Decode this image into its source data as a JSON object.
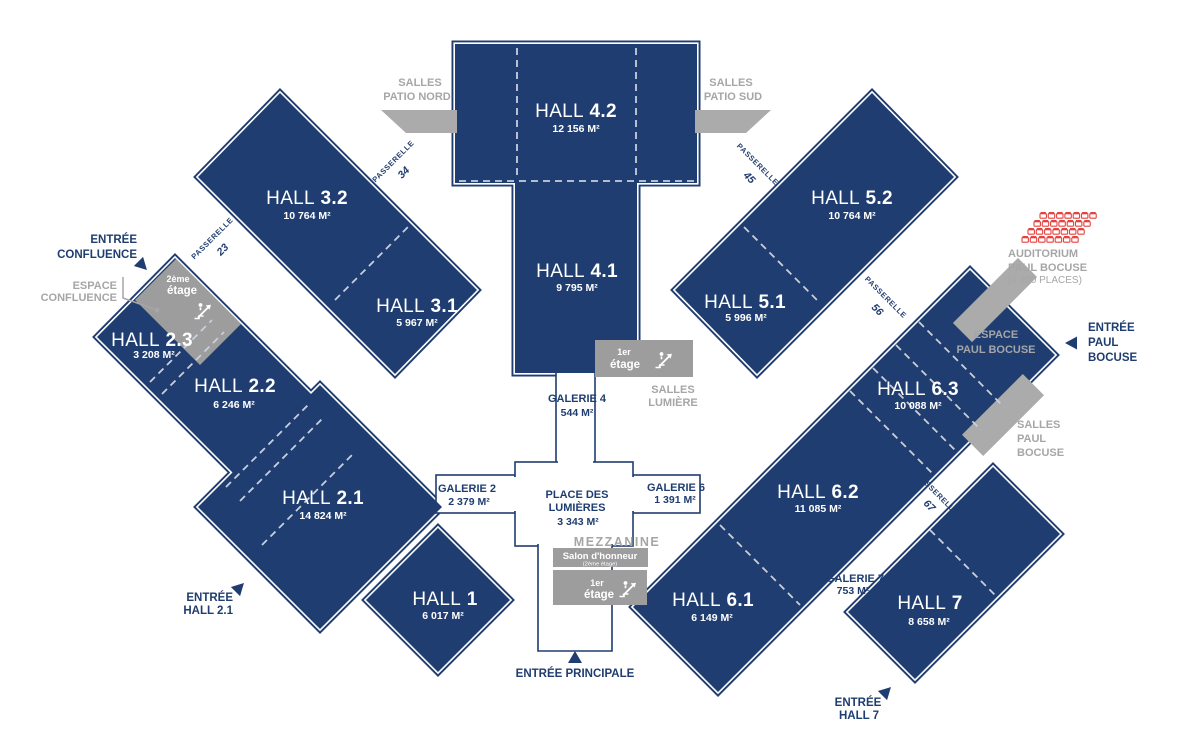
{
  "colors": {
    "navy": "#1f3d70",
    "gray_box": "#9d9d9d",
    "gray_patch": "#ababab",
    "gray_text": "#a6a6a6",
    "red_seats": "#e6413c",
    "dash": "#c8cfdb",
    "background": "#ffffff"
  },
  "halls": {
    "h42": {
      "name": "HALL",
      "number": "4.2",
      "area": "12 156 M²"
    },
    "h41": {
      "name": "HALL",
      "number": "4.1",
      "area": "9 795 M²"
    },
    "h32": {
      "name": "HALL",
      "number": "3.2",
      "area": "10 764 M²"
    },
    "h31": {
      "name": "HALL",
      "number": "3.1",
      "area": "5 967 M²"
    },
    "h23": {
      "name": "HALL",
      "number": "2.3",
      "area": "3 208 M²"
    },
    "h22": {
      "name": "HALL",
      "number": "2.2",
      "area": "6 246 M²"
    },
    "h21": {
      "name": "HALL",
      "number": "2.1",
      "area": "14 824 M²"
    },
    "h1": {
      "name": "HALL",
      "number": "1",
      "area": "6 017 M²"
    },
    "h52": {
      "name": "HALL",
      "number": "5.2",
      "area": "10 764 M²"
    },
    "h51": {
      "name": "HALL",
      "number": "5.1",
      "area": "5 996 M²"
    },
    "h63": {
      "name": "HALL",
      "number": "6.3",
      "area": "10 088 M²"
    },
    "h62": {
      "name": "HALL",
      "number": "6.2",
      "area": "11 085 M²"
    },
    "h61": {
      "name": "HALL",
      "number": "6.1",
      "area": "6 149 M²"
    },
    "h7": {
      "name": "HALL",
      "number": "7",
      "area": "8 658 M²"
    }
  },
  "galeries": {
    "g4": {
      "name": "GALERIE 4",
      "area": "544 M²"
    },
    "g2": {
      "name": "GALERIE 2",
      "area": "2 379 M²"
    },
    "g6": {
      "name": "GALERIE 6",
      "area": "1 391 M²"
    },
    "g7": {
      "name": "GALERIE 7",
      "area": "753 M²"
    }
  },
  "place": {
    "line1": "PLACE DES",
    "line2": "LUMIÈRES",
    "area": "3 343 M²"
  },
  "passerelles": {
    "word": "PASSERELLE",
    "p23": "23",
    "p34": "34",
    "p45": "45",
    "p56": "56",
    "p67": "67"
  },
  "entrances": {
    "confluence": {
      "line1": "ENTRÉE",
      "line2": "CONFLUENCE"
    },
    "hall21": {
      "line1": "ENTRÉE",
      "line2": "HALL 2.1"
    },
    "principale": {
      "label": "ENTRÉE PRINCIPALE"
    },
    "hall7": {
      "line1": "ENTRÉE",
      "line2": "HALL 7"
    },
    "paul_bocuse": {
      "line1": "ENTRÉE",
      "line2": "PAUL",
      "line3": "BOCUSE"
    }
  },
  "annex": {
    "salles_patio_nord": {
      "line1": "SALLES",
      "line2": "PATIO NORD"
    },
    "salles_patio_sud": {
      "line1": "SALLES",
      "line2": "PATIO SUD"
    },
    "salles_lumiere": {
      "line1": "SALLES",
      "line2": "LUMIÈRE"
    },
    "espace_confluence": {
      "line1": "ESPACE",
      "line2": "CONFLUENCE"
    },
    "espace_paul_bocuse": {
      "line1": "ESPACE",
      "line2": "PAUL BOCUSE"
    },
    "salles_paul_bocuse": {
      "line1": "SALLES",
      "line2": "PAUL",
      "line3": "BOCUSE"
    },
    "auditorium": {
      "line1": "AUDITORIUM",
      "line2": "PAUL BOCUSE",
      "line3": "(4 200 PLACES)"
    },
    "mezzanine": "MEZZANINE",
    "salon": {
      "line1": "Salon d'honneur",
      "line2": "(2ème étage)"
    },
    "etage2": {
      "line1": "2ème",
      "line2": "étage"
    },
    "etage1": {
      "line1": "1er",
      "line2": "étage"
    }
  }
}
